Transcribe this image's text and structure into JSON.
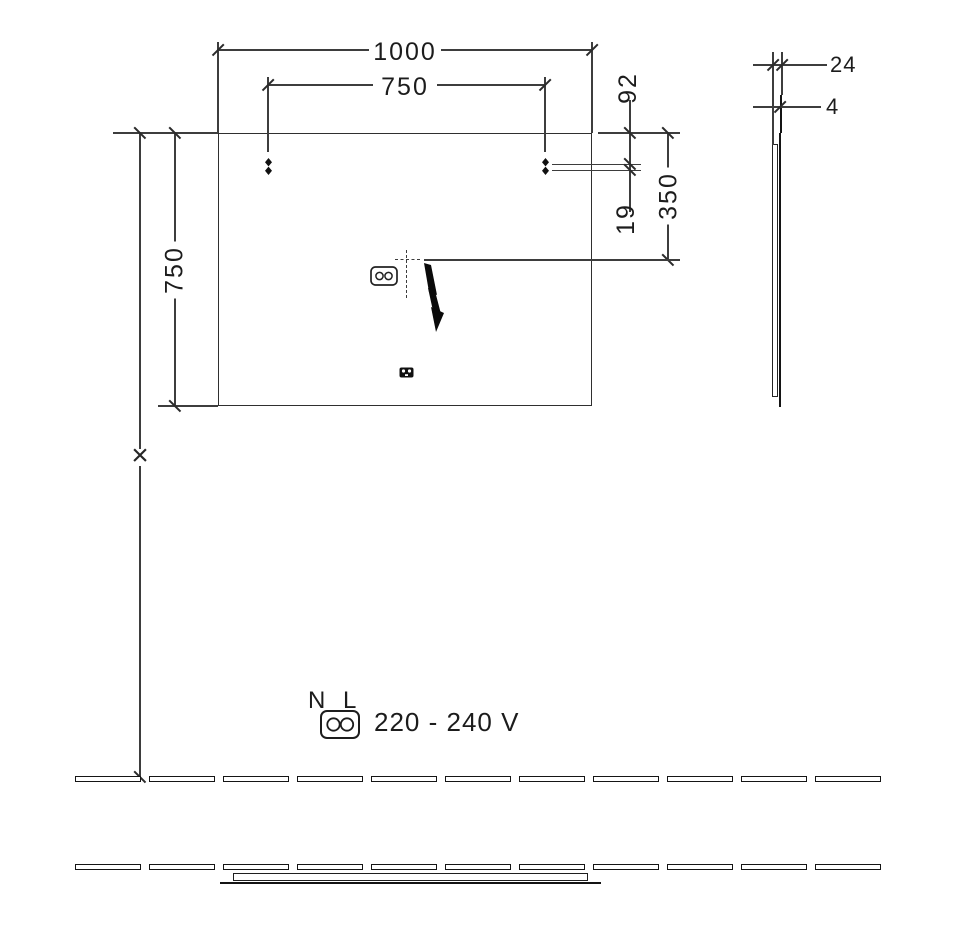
{
  "front_view": {
    "width": "1000",
    "mount_span": "750",
    "height": "750",
    "top_to_mount": "92",
    "mount_gap": "19",
    "top_to_connection": "350",
    "install_height_mark": "×"
  },
  "side_view": {
    "depth": "24",
    "glass": "4"
  },
  "electrical": {
    "neutral": "N",
    "line": "L",
    "voltage": "220 - 240 V"
  }
}
